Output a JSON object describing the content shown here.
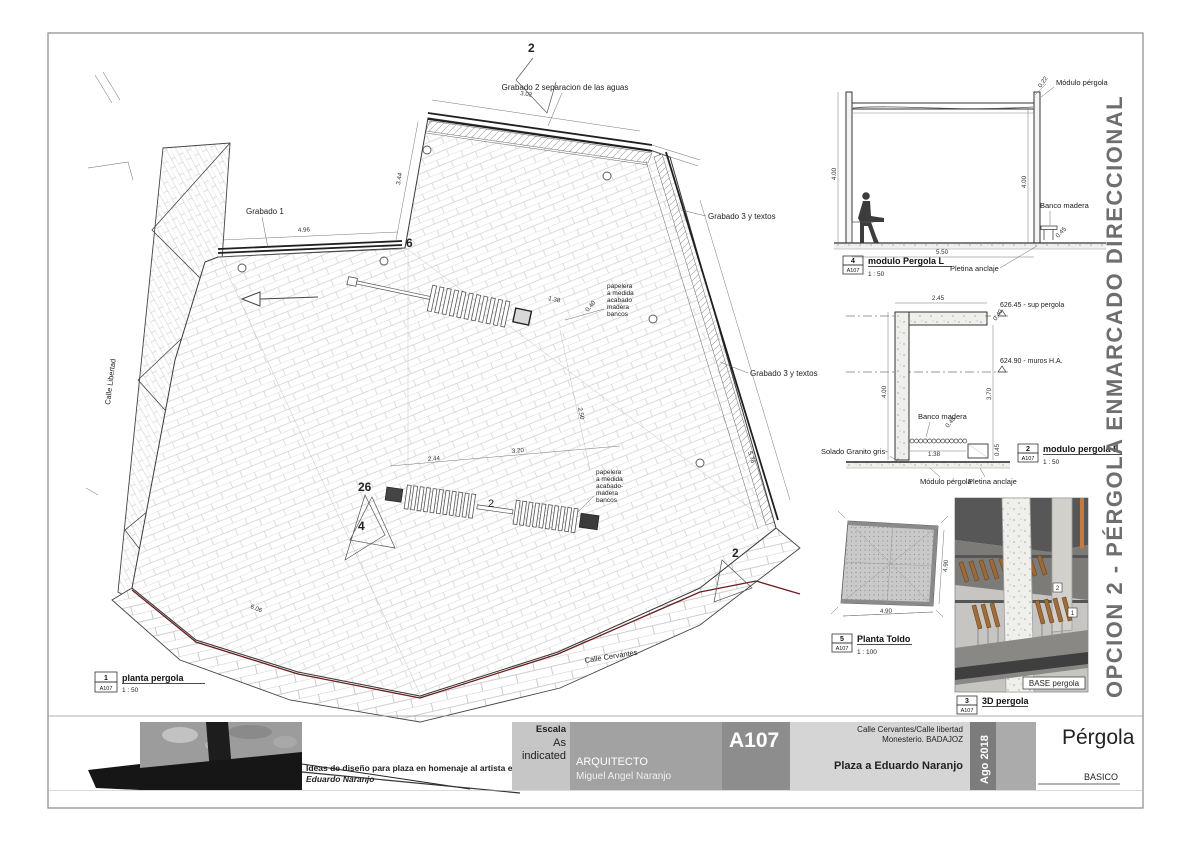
{
  "side_title": "OPCION 2 - PÉRGOLA ENMARCADO DIRECCIONAL",
  "plan": {
    "callouts": {
      "grabado1": "Grabado 1",
      "grabado2": "Grabado 2 separacion de las aguas",
      "grabado3_top": "Grabado 3 y textos",
      "grabado3_bottom": "Grabado 3 y textos",
      "papeleras_top": [
        "papelera",
        "a medida",
        "acabado",
        "madera",
        "bancos"
      ],
      "papeleras_bottom": [
        "papelera",
        "a medida",
        "acabado-",
        "madera",
        "bancos"
      ],
      "street_left": "Calle Libertad",
      "street_bottom": "Calle Cervantes"
    },
    "markers": {
      "top": "2",
      "corner": "6",
      "m26": "26",
      "m4": "4",
      "mid": "2",
      "bottom": "2"
    },
    "dims": {
      "top": "3.02",
      "diag": "3.44",
      "grabado1_len": "4.96",
      "bench1_len": "1.38",
      "bench1_w": "0.40",
      "bench2_a": "2.44",
      "bench2_b": "3.20",
      "mid_v": "2.50",
      "right_edge": "5.76",
      "bottom_left": "6.06"
    },
    "title": {
      "num": "1",
      "ref": "A107",
      "label": "planta pergola",
      "scale": "1 : 50"
    }
  },
  "section_l": {
    "labels": {
      "modulo": "Módulo pérgola",
      "banco": "Banco madera",
      "pletina": "Pletina anclaje"
    },
    "dims": {
      "left": "4.00",
      "right": "4.00",
      "bottom": "5.50",
      "beam": "0.22",
      "bench": "0.45"
    },
    "title": {
      "num": "4",
      "ref": "A107",
      "label": "modulo Pergola L",
      "scale": "1 : 50"
    }
  },
  "section_f": {
    "levels": {
      "top": "626.45 - sup pergola",
      "mid": "624.90 - muros H.A."
    },
    "labels": {
      "banco": "Banco madera",
      "solado": "Solado Granito gris-",
      "modulo": "Módulo pérgola",
      "pletina": "Pletina anclaje"
    },
    "dims": {
      "top": "2.45",
      "beam": "0.40",
      "left": "4.00",
      "right": "3.70",
      "bench_h": "0.45",
      "bench_w": "1.38",
      "base": "0.45"
    },
    "title": {
      "num": "2",
      "ref": "A107",
      "label": "modulo pergola F",
      "scale": "1 : 50"
    }
  },
  "toldo": {
    "dims": {
      "bottom": "4.90",
      "side": "4.90"
    },
    "title": {
      "num": "5",
      "ref": "A107",
      "label": "Planta Toldo",
      "scale": "1 : 100"
    }
  },
  "view3d": {
    "tags": {
      "t1": "1",
      "t2": "2",
      "base": "BASE pergola"
    },
    "title": {
      "num": "3",
      "ref": "A107",
      "label": "3D pergola"
    }
  },
  "titleblock": {
    "caption_line1": "Ideas de diseño para plaza en homenaje al artista extremeño",
    "caption_line2": "Eduardo Naranjo",
    "escala_label": "Escala",
    "escala_value_1": "As",
    "escala_value_2": "indicated",
    "arquitecto_label": "ARQUITECTO",
    "arquitecto_name": "Miguel Angel Naranjo",
    "sheet_number": "A107",
    "address_line1": "Calle Cervantes/Calle libertad",
    "address_line2": "Monesterio. BADAJOZ",
    "project": "Plaza a Eduardo Naranjo",
    "date": "Ago 2018",
    "doc_title": "Pérgola",
    "phase": "BASICO"
  },
  "colors": {
    "accent_red": "#6b1d1d",
    "wood": "#9c6a38",
    "orange": "#c8793c",
    "concrete": "#dbd9d4",
    "wall_dark": "#575757",
    "side_title_gray": "#6e6e6e"
  }
}
